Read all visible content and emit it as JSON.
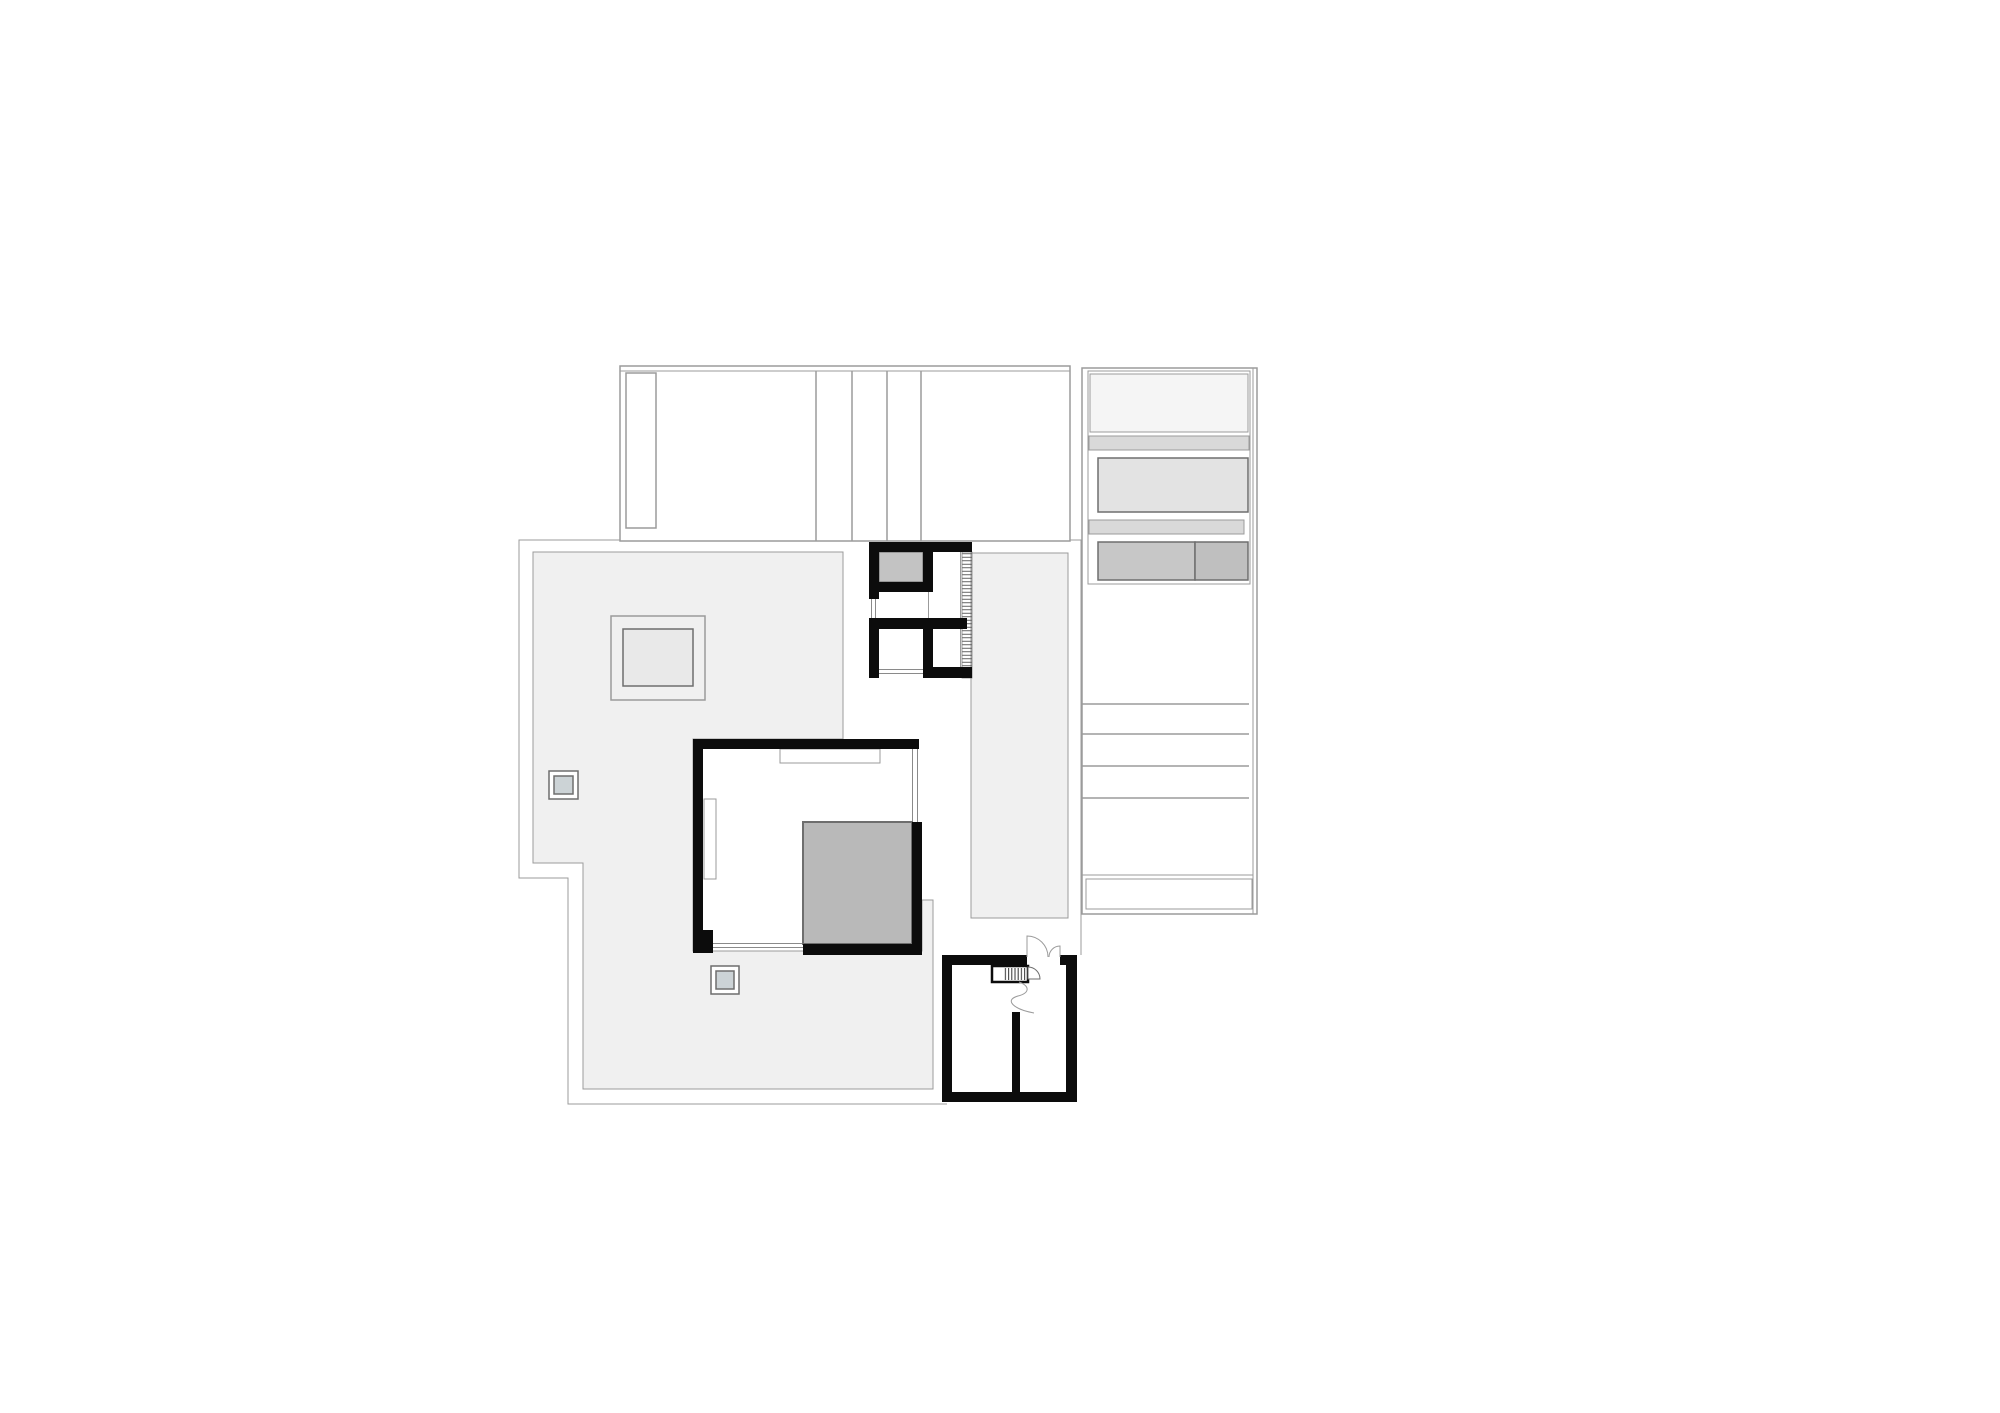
{
  "document": {
    "kind": "architectural floor plan drawing",
    "background": "#ffffff"
  },
  "colors": {
    "wall": "#0c0c0c",
    "line": "#9b9b9b",
    "line_dark": "#6e6e6e",
    "glazing": "#8a8a8a",
    "terrace": "#f0f0f0",
    "corridor": "#f0f0f0",
    "skylight": "#e9e9e9",
    "stair_core": "#b9b9b9",
    "bath_gray": "#c3c3c3",
    "drain": "#ccd3d6",
    "garage_block_light": "#f5f5f5",
    "garage_strip": "#d9d9d9",
    "garage_block_mid": "#e3e3e3",
    "garage_block_dark_a": "#c7c7c7",
    "garage_block_dark_b": "#bfbfbf"
  },
  "legend": {
    "upper_wing": "upper building wing outline",
    "carport_wing": "right wing with parking / storage blocks",
    "roof_terrace": "large roof terrace surface",
    "skylight": "square skylight opening",
    "drains": "two small roof drains",
    "corridor": "vertical walkway strip",
    "bathroom_block": "small-room block with stair rail hatch",
    "living_room": "main room with thick walls and core",
    "stair_core": "gray stair / elevator core",
    "entrance_room": "entry room with double door and stairs"
  }
}
